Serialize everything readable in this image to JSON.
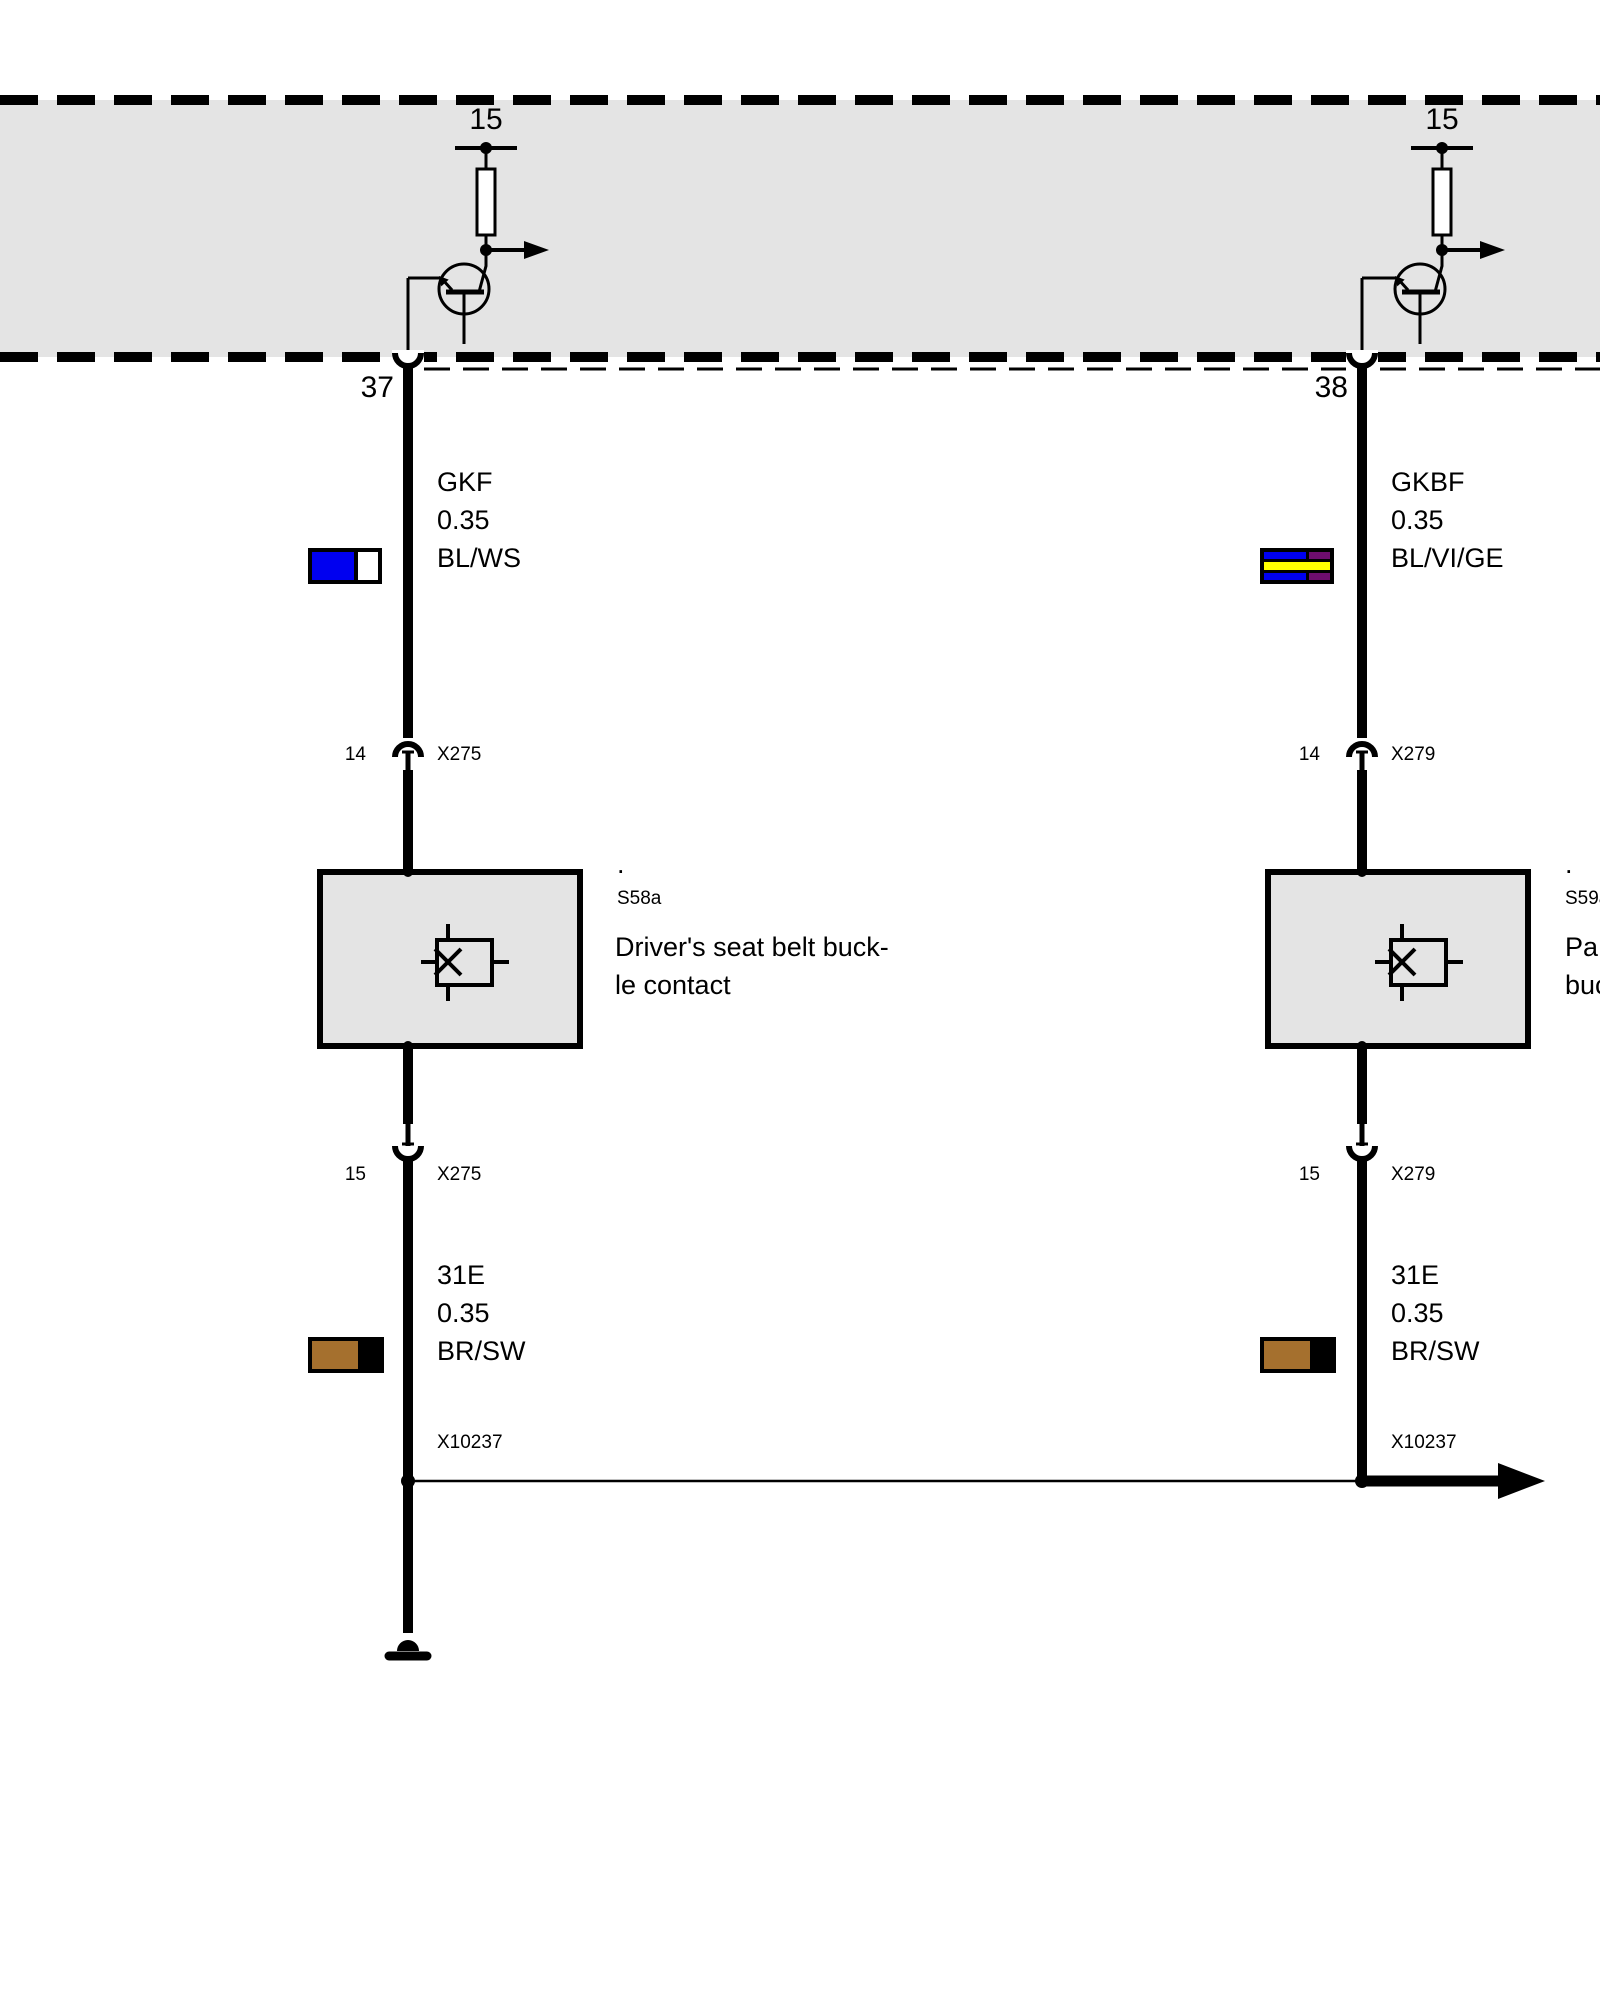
{
  "module_band": {
    "left_circuit": {
      "terminal_label": "15",
      "pin_label": "37"
    },
    "right_circuit": {
      "terminal_label": "15",
      "pin_label": "38"
    }
  },
  "left_branch": {
    "upper_wire": {
      "signal": "GKF",
      "gauge": "0.35",
      "color_code": "BL/WS"
    },
    "upper_connector": {
      "pin": "14",
      "label": "X275"
    },
    "component": {
      "dot": ".",
      "id": "S58a",
      "description_line1": "Driver's seat belt buck-",
      "description_line2": "le contact"
    },
    "lower_connector": {
      "pin": "15",
      "label": "X275"
    },
    "lower_wire": {
      "signal": "31E",
      "gauge": "0.35",
      "color_code": "BR/SW"
    },
    "splice": {
      "label": "X10237"
    }
  },
  "right_branch": {
    "upper_wire": {
      "signal": "GKBF",
      "gauge": "0.35",
      "color_code": "BL/VI/GE"
    },
    "upper_connector": {
      "pin": "14",
      "label": "X279"
    },
    "component": {
      "dot": ".",
      "id": "S59a",
      "description_line1": "Pa",
      "description_line2": "buc"
    },
    "lower_connector": {
      "pin": "15",
      "label": "X279"
    },
    "lower_wire": {
      "signal": "31E",
      "gauge": "0.35",
      "color_code": "BR/SW"
    },
    "splice": {
      "label": "X10237"
    }
  },
  "colors": {
    "band_gray": "#e4e4e4",
    "wire_black": "#000000",
    "blue": "#0000f0",
    "white": "#ffffff",
    "violet": "#6e0d6e",
    "yellow": "#ffff00",
    "brown": "#a5702e",
    "black": "#000000"
  }
}
